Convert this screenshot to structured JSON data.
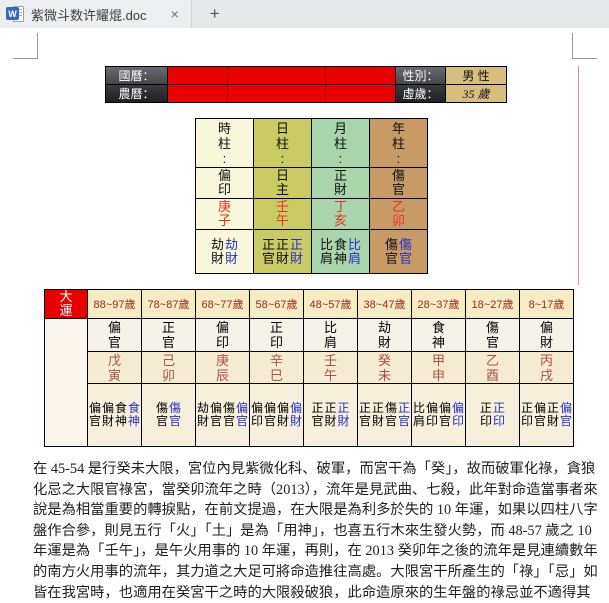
{
  "tab": {
    "title": "紫微斗数许耀焜.doc",
    "close_label": "×",
    "new_tab_label": "+",
    "doc_icon_letter": "W"
  },
  "info_table": {
    "rows": [
      {
        "label": "國曆：",
        "right_label": "性別：",
        "right_value": "男 性"
      },
      {
        "label": "農曆：",
        "right_label": "虛歲：",
        "right_value": "35 歲"
      }
    ]
  },
  "pillars": {
    "columns": [
      {
        "header": "時柱:",
        "shishen": "偏印",
        "ganzhi": "庚子",
        "bg": "#f8f7da",
        "hidden": [
          {
            "t": "劫財",
            "blue": false
          },
          {
            "t": "劫財",
            "blue": true
          }
        ]
      },
      {
        "header": "日柱:",
        "shishen": "日主",
        "ganzhi": "壬午",
        "bg": "#cbcb63",
        "hidden": [
          {
            "t": "正官",
            "blue": false
          },
          {
            "t": "正財",
            "blue": false
          },
          {
            "t": "正財",
            "blue": true
          }
        ]
      },
      {
        "header": "月柱:",
        "shishen": "正財",
        "ganzhi": "丁亥",
        "bg": "#a8d5ac",
        "hidden": [
          {
            "t": "比肩",
            "blue": false
          },
          {
            "t": "食神",
            "blue": false
          },
          {
            "t": "比肩",
            "blue": true
          }
        ]
      },
      {
        "header": "年柱:",
        "shishen": "傷官",
        "ganzhi": "乙卯",
        "bg": "#c79a66",
        "hidden": [
          {
            "t": "傷官",
            "blue": false
          },
          {
            "t": "傷官",
            "blue": true
          }
        ]
      }
    ]
  },
  "dayun": {
    "title": "大運",
    "columns": [
      {
        "age": "88~97歲",
        "shishen": "偏官",
        "ganzhi": "戊寅",
        "hidden": [
          {
            "t": "偏官",
            "blue": false
          },
          {
            "t": "偏財",
            "blue": false
          },
          {
            "t": "食神",
            "blue": false
          },
          {
            "t": "食神",
            "blue": true
          }
        ]
      },
      {
        "age": "78~87歲",
        "shishen": "正官",
        "ganzhi": "己卯",
        "hidden": [
          {
            "t": "傷官",
            "blue": false
          },
          {
            "t": "傷官",
            "blue": true
          }
        ]
      },
      {
        "age": "68~77歲",
        "shishen": "偏印",
        "ganzhi": "庚辰",
        "hidden": [
          {
            "t": "劫財",
            "blue": false
          },
          {
            "t": "偏官",
            "blue": false
          },
          {
            "t": "傷官",
            "blue": false
          },
          {
            "t": "偏官",
            "blue": true
          }
        ]
      },
      {
        "age": "58~67歲",
        "shishen": "正印",
        "ganzhi": "辛巳",
        "hidden": [
          {
            "t": "偏印",
            "blue": false
          },
          {
            "t": "偏官",
            "blue": false
          },
          {
            "t": "偏財",
            "blue": false
          },
          {
            "t": "偏財",
            "blue": true
          }
        ]
      },
      {
        "age": "48~57歲",
        "shishen": "比肩",
        "ganzhi": "壬午",
        "hidden": [
          {
            "t": "正官",
            "blue": false
          },
          {
            "t": "正財",
            "blue": false
          },
          {
            "t": "正財",
            "blue": true
          }
        ]
      },
      {
        "age": "38~47歲",
        "shishen": "劫財",
        "ganzhi": "癸未",
        "hidden": [
          {
            "t": "正官",
            "blue": false
          },
          {
            "t": "正財",
            "blue": false
          },
          {
            "t": "傷官",
            "blue": false
          },
          {
            "t": "正官",
            "blue": true
          }
        ]
      },
      {
        "age": "28~37歲",
        "shishen": "食神",
        "ganzhi": "甲申",
        "hidden": [
          {
            "t": "比肩",
            "blue": false
          },
          {
            "t": "偏印",
            "blue": false
          },
          {
            "t": "偏官",
            "blue": false
          },
          {
            "t": "偏印",
            "blue": true
          }
        ]
      },
      {
        "age": "18~27歲",
        "shishen": "傷官",
        "ganzhi": "乙酉",
        "hidden": [
          {
            "t": "正印",
            "blue": false
          },
          {
            "t": "正印",
            "blue": true
          }
        ]
      },
      {
        "age": "8~17歲",
        "shishen": "偏財",
        "ganzhi": "丙戌",
        "hidden": [
          {
            "t": "正印",
            "blue": false
          },
          {
            "t": "偏官",
            "blue": false
          },
          {
            "t": "正財",
            "blue": false
          },
          {
            "t": "偏官",
            "blue": true
          }
        ]
      }
    ]
  },
  "paragraph": {
    "lines": [
      "在 45-54 是行癸未大限，宮位內見紫微化科、破軍，而宮干為「癸」，故而破軍化祿，貪狼",
      "化忌之大限官祿宮，當癸卯流年之時（2013），流年是見武曲、七殺，此年對命造當事者來",
      "說是為相當重要的轉捩點，在前文提過，在大限是為利多於失的 10 年運，如果以四柱八字",
      "盤作合參，則見五行「火」「土」是為「用神」，也喜五行木來生發火勢，而 48-57 歲之 10",
      "年運是為「壬午」，是午火用事的 10 年運，再則，在 2013 癸卯年之後的流年是見連續數年",
      "的南方火用事的流年，其力道之大足可將命造推往高處。大限宮干所產生的「祿」「忌」如",
      "皆在我宮時，也適用在癸宮干之時的大限殺破狼，此命造原來的生年盤的祿忌並不適得其"
    ]
  },
  "colors": {
    "accent_red": "#e60000",
    "info_red_cell": "#e90000",
    "tan_value_cell": "#d7be7d",
    "hidden_blue_text": "#2733c4",
    "pillar_ganzhi_red": "#e8321e",
    "dayun_ganzhi_red": "#a6524a",
    "dayun_age_text": "#9e2a22"
  }
}
